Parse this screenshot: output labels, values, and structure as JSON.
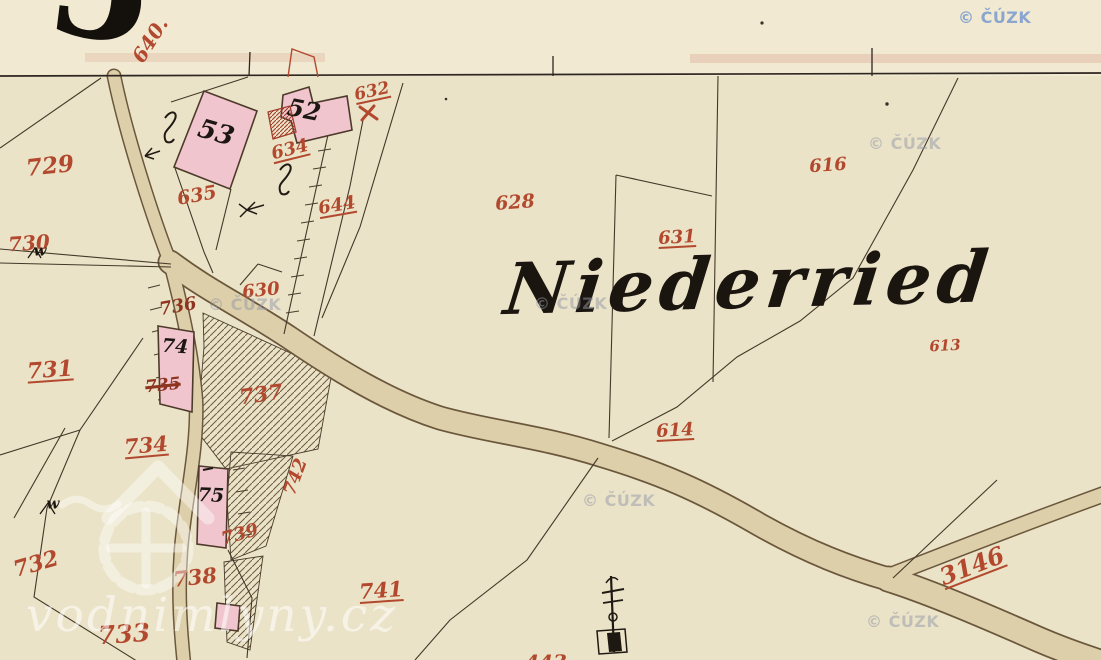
{
  "map": {
    "title": "Niederried",
    "sheet_number_fragment": "5",
    "partial_bottom_label": "443"
  },
  "palette": {
    "paper": "#ebe3c8",
    "paper_top": "#f1e9d2",
    "road_fill": "#dccfa9",
    "road_edge": "#6b573c",
    "line": "#443828",
    "ink": "#1d1712",
    "red_label": "#b2492e",
    "dark_red": "#8e3522",
    "building_fill": "#f0c5cd",
    "building_stroke": "#4d3a2a",
    "annex_red": "#a2402c",
    "watermark_blue": "#7e9ece",
    "watermark_gray": "#9498a6",
    "brand_white": "#ffffff"
  },
  "labels": [
    {
      "name": "parcel-640",
      "text": "640.",
      "x": 150,
      "y": 40,
      "rot": -58,
      "size": 20,
      "color": "red"
    },
    {
      "name": "parcel-729",
      "text": "729",
      "x": 50,
      "y": 166,
      "rot": -6,
      "size": 23,
      "color": "red"
    },
    {
      "name": "parcel-730",
      "text": "730",
      "x": 29,
      "y": 243,
      "rot": -4,
      "size": 20,
      "color": "red"
    },
    {
      "name": "parcel-731",
      "text": "731",
      "x": 50,
      "y": 370,
      "rot": -4,
      "size": 22,
      "color": "red",
      "u": true
    },
    {
      "name": "parcel-732",
      "text": "732",
      "x": 36,
      "y": 564,
      "rot": -16,
      "size": 22,
      "color": "red"
    },
    {
      "name": "parcel-733",
      "text": "733",
      "x": 124,
      "y": 634,
      "rot": -4,
      "size": 25,
      "color": "red"
    },
    {
      "name": "parcel-734",
      "text": "734",
      "x": 146,
      "y": 445,
      "rot": -5,
      "size": 21,
      "color": "red",
      "u": true
    },
    {
      "name": "parcel-735-struck",
      "text": "735",
      "x": 163,
      "y": 386,
      "rot": -6,
      "size": 17,
      "color": "darkred",
      "strike": true
    },
    {
      "name": "parcel-736",
      "text": "736",
      "x": 178,
      "y": 307,
      "rot": -10,
      "size": 18,
      "color": "darkred"
    },
    {
      "name": "parcel-737",
      "text": "737",
      "x": 261,
      "y": 394,
      "rot": -8,
      "size": 21,
      "color": "red"
    },
    {
      "name": "parcel-738",
      "text": "738",
      "x": 195,
      "y": 577,
      "rot": -6,
      "size": 21,
      "color": "red"
    },
    {
      "name": "parcel-739",
      "text": "739",
      "x": 240,
      "y": 535,
      "rot": -16,
      "size": 18,
      "color": "red"
    },
    {
      "name": "parcel-741",
      "text": "741",
      "x": 381,
      "y": 590,
      "rot": -4,
      "size": 21,
      "color": "red",
      "u": true
    },
    {
      "name": "parcel-742",
      "text": "742",
      "x": 296,
      "y": 477,
      "rot": -70,
      "size": 18,
      "color": "red"
    },
    {
      "name": "parcel-635",
      "text": "635",
      "x": 197,
      "y": 196,
      "rot": -10,
      "size": 19,
      "color": "red"
    },
    {
      "name": "parcel-634",
      "text": "634",
      "x": 290,
      "y": 150,
      "rot": -14,
      "size": 18,
      "color": "red",
      "u": true
    },
    {
      "name": "parcel-644",
      "text": "644",
      "x": 337,
      "y": 206,
      "rot": -10,
      "size": 18,
      "color": "red",
      "u": true
    },
    {
      "name": "parcel-632",
      "text": "632",
      "x": 372,
      "y": 92,
      "rot": -12,
      "size": 17,
      "color": "red",
      "u": true
    },
    {
      "name": "parcel-630",
      "text": "630",
      "x": 261,
      "y": 291,
      "rot": -6,
      "size": 18,
      "color": "red"
    },
    {
      "name": "parcel-628",
      "text": "628",
      "x": 515,
      "y": 203,
      "rot": -4,
      "size": 19,
      "color": "red"
    },
    {
      "name": "parcel-631",
      "text": "631",
      "x": 677,
      "y": 238,
      "rot": -3,
      "size": 18,
      "color": "red",
      "u": true
    },
    {
      "name": "parcel-616",
      "text": "616",
      "x": 828,
      "y": 166,
      "rot": -4,
      "size": 18,
      "color": "red"
    },
    {
      "name": "parcel-613",
      "text": "613",
      "x": 945,
      "y": 346,
      "rot": -3,
      "size": 15,
      "color": "red"
    },
    {
      "name": "parcel-614",
      "text": "614",
      "x": 675,
      "y": 431,
      "rot": -3,
      "size": 18,
      "color": "red",
      "u": true
    },
    {
      "name": "parcel-3146",
      "text": "3146",
      "x": 972,
      "y": 566,
      "rot": -21,
      "size": 24,
      "color": "red",
      "u": true
    },
    {
      "name": "parcel-443-partial",
      "text": "443",
      "x": 546,
      "y": 662,
      "rot": 0,
      "size": 20,
      "color": "red"
    },
    {
      "name": "building-53",
      "text": "53",
      "x": 216,
      "y": 133,
      "rot": 16,
      "size": 26,
      "color": "black"
    },
    {
      "name": "building-52",
      "text": "52",
      "x": 304,
      "y": 110,
      "rot": 11,
      "size": 24,
      "color": "black"
    },
    {
      "name": "building-74",
      "text": "74",
      "x": 175,
      "y": 347,
      "rot": 4,
      "size": 19,
      "color": "black"
    },
    {
      "name": "building-75",
      "text": "75",
      "x": 211,
      "y": 496,
      "rot": 2,
      "size": 19,
      "color": "black"
    },
    {
      "name": "marker-w-1",
      "text": "w",
      "x": 40,
      "y": 251,
      "rot": 0,
      "size": 15,
      "color": "black"
    },
    {
      "name": "marker-w-2",
      "text": "w",
      "x": 53,
      "y": 504,
      "rot": 0,
      "size": 15,
      "color": "black"
    }
  ],
  "watermarks": [
    {
      "text": "© ČÚZK",
      "x": 958,
      "y": 8,
      "variant": "blue"
    },
    {
      "text": "© ČÚZK",
      "x": 868,
      "y": 134,
      "variant": "gray"
    },
    {
      "text": "© ČÚZK",
      "x": 208,
      "y": 295,
      "variant": "gray"
    },
    {
      "text": "© ČÚZK",
      "x": 534,
      "y": 294,
      "variant": "gray"
    },
    {
      "text": "© ČÚZK",
      "x": 582,
      "y": 491,
      "variant": "gray"
    },
    {
      "text": "© ČÚZK",
      "x": 866,
      "y": 612,
      "variant": "gray"
    }
  ],
  "brand_watermark": {
    "text": "vodnimlyny.cz"
  },
  "symbols": [
    "cross-monument-symbol",
    "boundary-marker-w",
    "garden-flourish-symbol",
    "spring-arrow-symbol",
    "survey-tick-marks"
  ]
}
